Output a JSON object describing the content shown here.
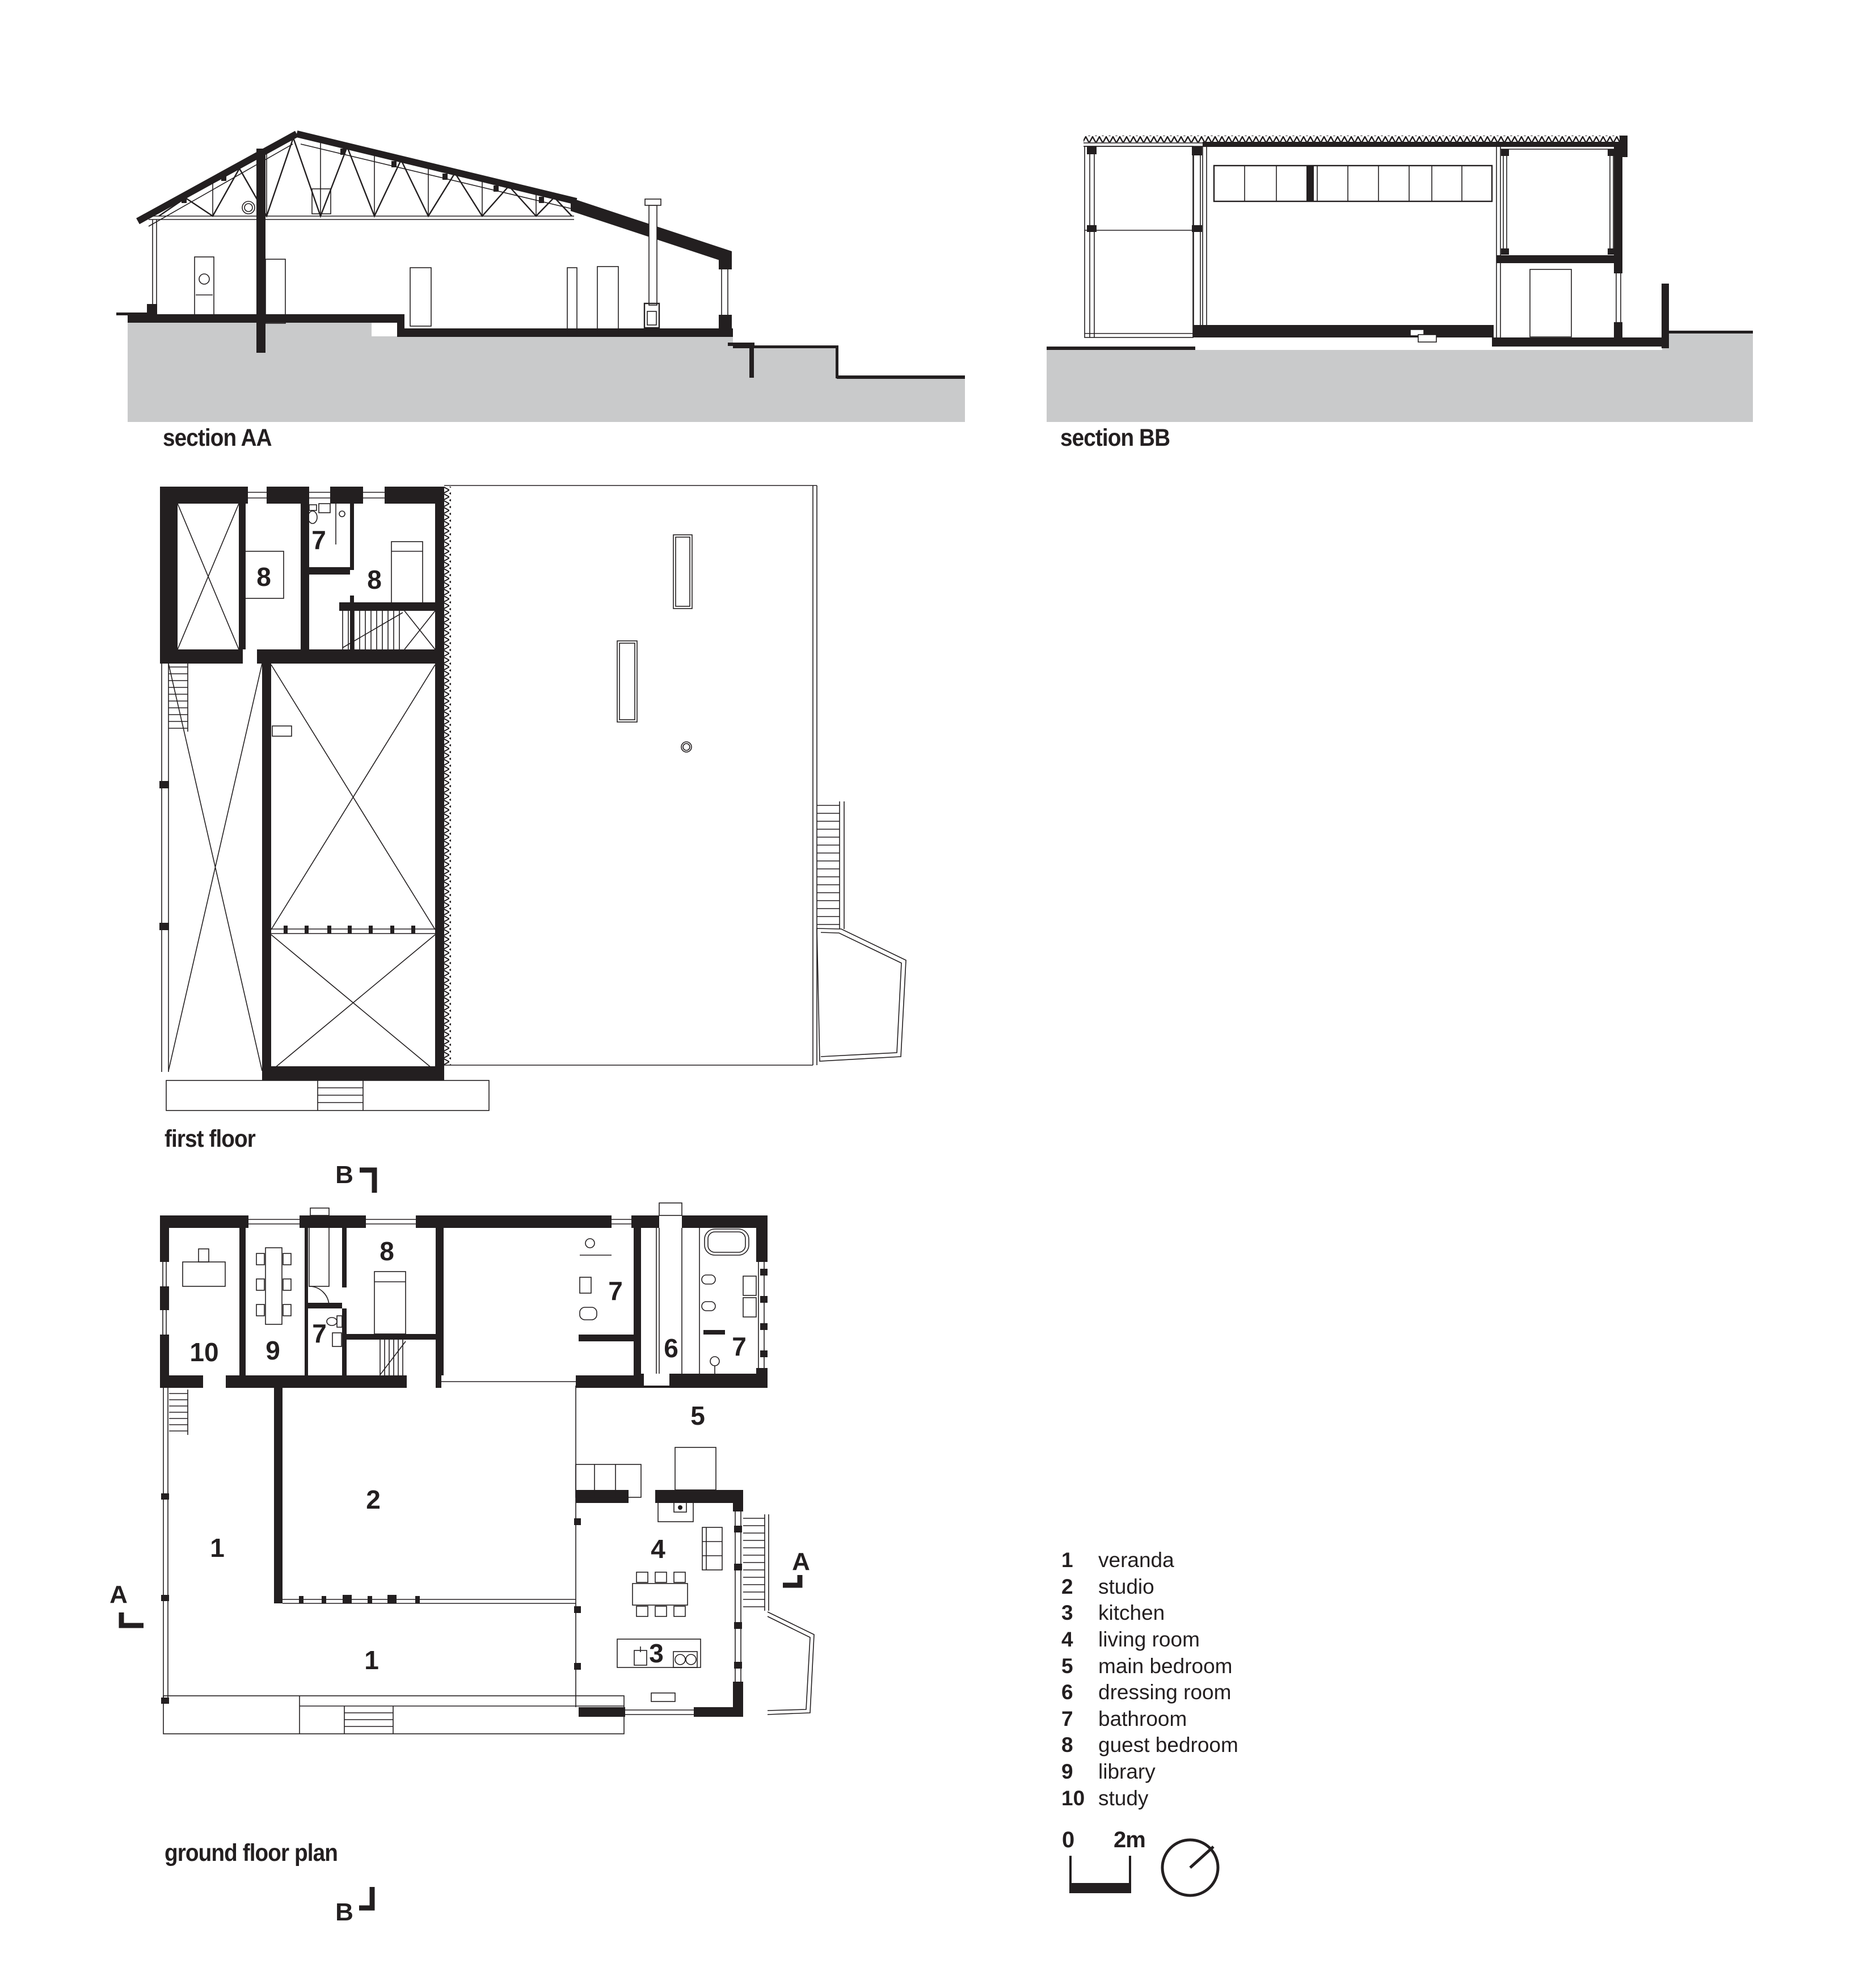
{
  "page": {
    "background": "#ffffff",
    "ink": "#231f20",
    "ground_gray": "#c9cacb"
  },
  "sections": {
    "aa": {
      "label": "section AA"
    },
    "bb": {
      "label": "section BB"
    }
  },
  "plans": {
    "first_floor": {
      "label": "first floor",
      "rooms": {
        "guest_a": "8",
        "bath": "7",
        "guest_b": "8"
      }
    },
    "ground_floor": {
      "label": "ground floor plan",
      "rooms": {
        "study": "10",
        "library": "9",
        "bath_a": "7",
        "guest": "8",
        "bath_b": "7",
        "dressing": "6",
        "bath_c": "7",
        "main_bedroom": "5",
        "studio": "2",
        "veranda_west": "1",
        "living": "4",
        "kitchen": "3",
        "veranda_south": "1"
      }
    }
  },
  "markers": {
    "section_a": "A",
    "section_b": "B"
  },
  "legend": {
    "items": [
      {
        "num": "1",
        "name": "veranda"
      },
      {
        "num": "2",
        "name": "studio"
      },
      {
        "num": "3",
        "name": "kitchen"
      },
      {
        "num": "4",
        "name": "living room"
      },
      {
        "num": "5",
        "name": "main bedroom"
      },
      {
        "num": "6",
        "name": "dressing room"
      },
      {
        "num": "7",
        "name": "bathroom"
      },
      {
        "num": "8",
        "name": "guest bedroom"
      },
      {
        "num": "9",
        "name": "library"
      },
      {
        "num": "10",
        "name": "study"
      }
    ]
  },
  "scale_bar": {
    "start": "0",
    "end": "2m"
  },
  "icons": {
    "north": "north-arrow-compass"
  }
}
